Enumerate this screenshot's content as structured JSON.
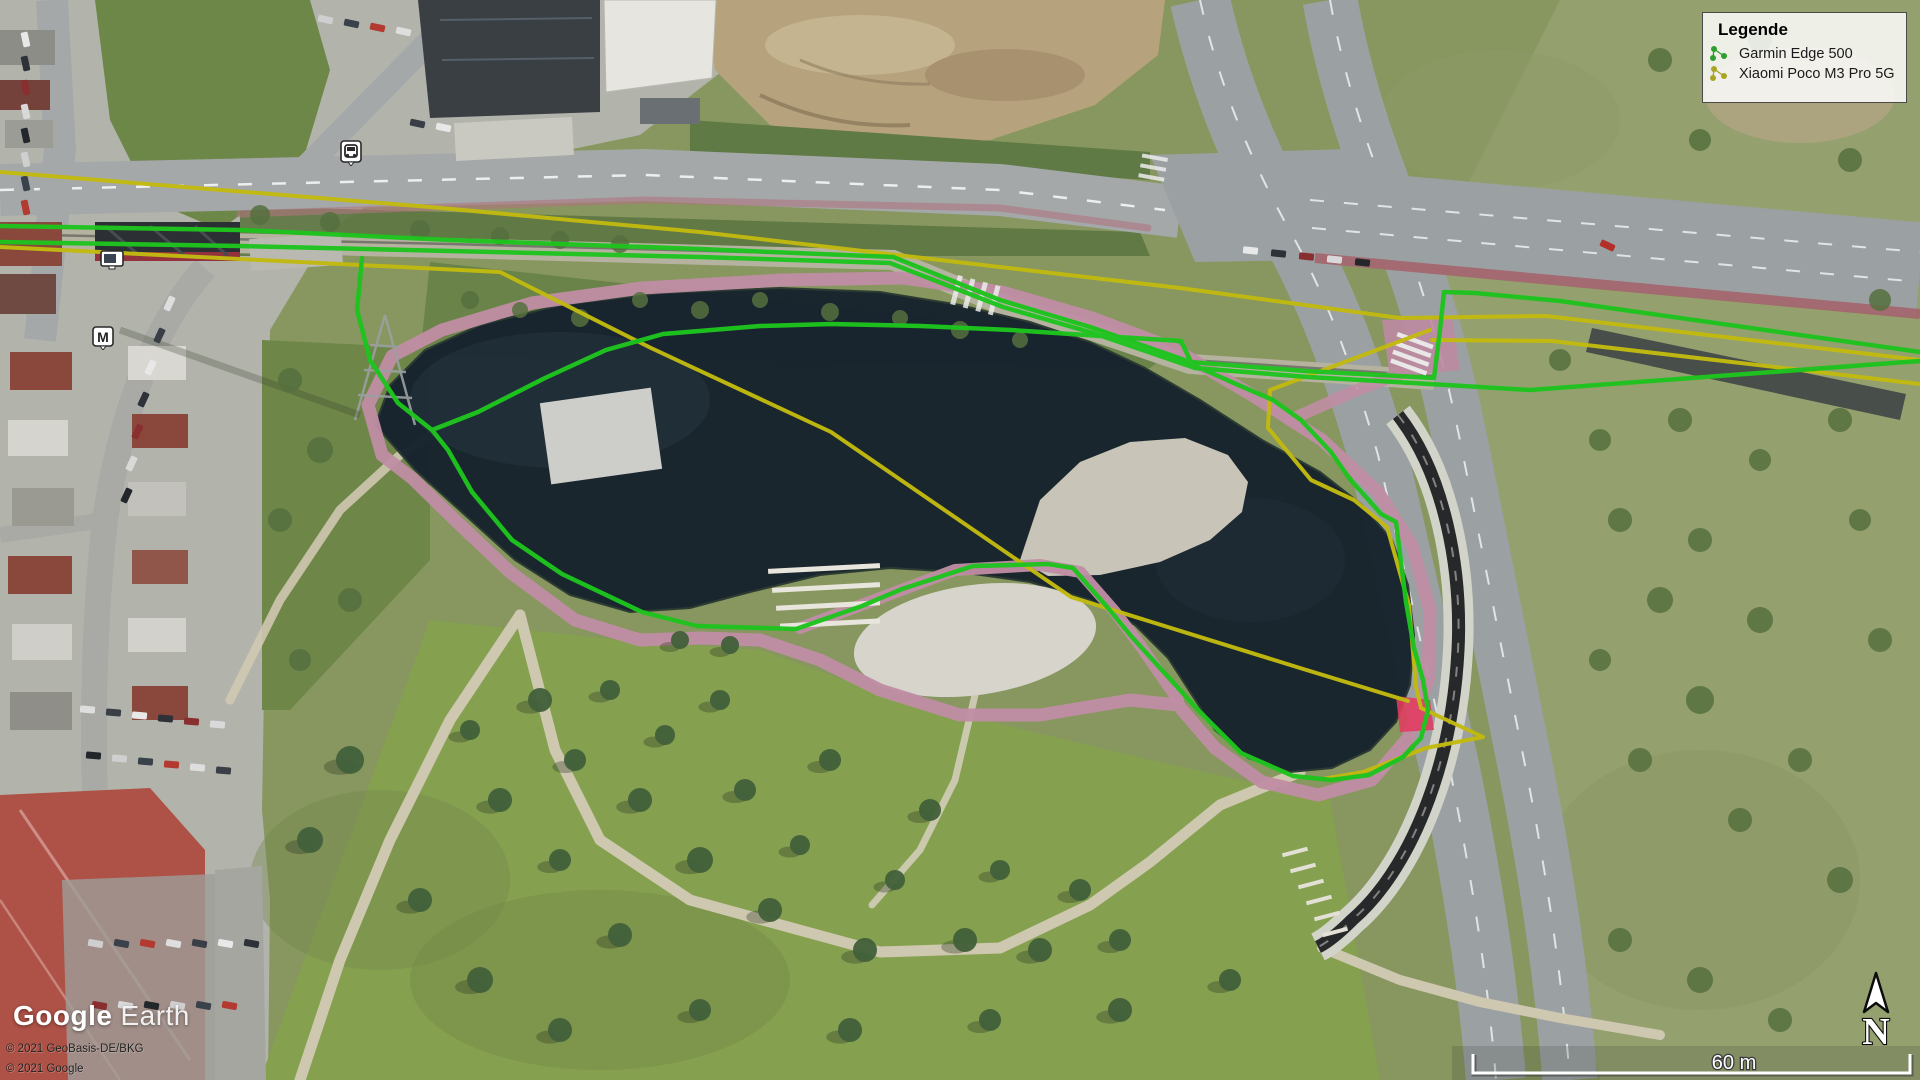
{
  "app": {
    "title": "Google Earth"
  },
  "legend": {
    "title": "Legende",
    "items": [
      {
        "id": "garmin",
        "label": "Garmin Edge 500",
        "color": "#2f9e2f"
      },
      {
        "id": "xiaomi",
        "label": "Xiaomi Poco M3 Pro 5G",
        "color": "#a8a425"
      }
    ]
  },
  "watermark": {
    "brand": "Google",
    "product": "Earth"
  },
  "attribution": {
    "line1": "© 2021 GeoBasis-DE/BKG",
    "line2": "© 2021 Google"
  },
  "scale_bar": {
    "label": "60 m"
  },
  "compass": {
    "label": "N"
  },
  "poi": {
    "station_label": "M"
  },
  "tracks": {
    "series": [
      {
        "id": "xiaomi",
        "color": "#c2ba10",
        "width": 4,
        "segments": [
          [
            [
              0,
              172
            ],
            [
              430,
              207
            ],
            [
              700,
              232
            ],
            [
              1180,
              288
            ],
            [
              1400,
              318
            ],
            [
              1546,
              316
            ],
            [
              1920,
              360
            ]
          ],
          [
            [
              0,
              247
            ],
            [
              300,
              262
            ],
            [
              500,
              272
            ],
            [
              651,
              348
            ],
            [
              831,
              432
            ],
            [
              1071,
              597
            ],
            [
              1300,
              668
            ],
            [
              1408,
              701
            ]
          ],
          [
            [
              1430,
              330
            ],
            [
              1302,
              378
            ],
            [
              1270,
              390
            ],
            [
              1268,
              428
            ],
            [
              1311,
              480
            ],
            [
              1354,
              500
            ],
            [
              1387,
              527
            ],
            [
              1409,
              605
            ],
            [
              1416,
              687
            ],
            [
              1421,
              708
            ],
            [
              1483,
              737
            ],
            [
              1426,
              748
            ],
            [
              1363,
              772
            ],
            [
              1323,
              779
            ]
          ],
          [
            [
              1432,
              340
            ],
            [
              1552,
              341
            ],
            [
              1920,
              384
            ]
          ]
        ]
      },
      {
        "id": "garmin",
        "color": "#1ec41e",
        "width": 4.5,
        "segments": [
          [
            [
              0,
              226
            ],
            [
              240,
              230
            ],
            [
              450,
              240
            ],
            [
              700,
              249
            ],
            [
              893,
              257
            ],
            [
              1000,
              300
            ],
            [
              1090,
              327
            ],
            [
              1190,
              362
            ],
            [
              1305,
              371
            ],
            [
              1434,
              378
            ],
            [
              1440,
              330
            ],
            [
              1444,
              292
            ],
            [
              1475,
              293
            ],
            [
              1560,
              301
            ],
            [
              1920,
              352
            ]
          ],
          [
            [
              0,
              242
            ],
            [
              240,
              246
            ],
            [
              450,
              251
            ],
            [
              700,
              257
            ],
            [
              890,
              263
            ],
            [
              1003,
              307
            ],
            [
              1093,
              333
            ],
            [
              1195,
              368
            ],
            [
              1308,
              377
            ],
            [
              1430,
              384
            ],
            [
              1530,
              390
            ],
            [
              1920,
              361
            ]
          ],
          [
            [
              362,
              258
            ],
            [
              357,
              310
            ],
            [
              370,
              360
            ],
            [
              398,
              403
            ],
            [
              432,
              430
            ],
            [
              448,
              450
            ],
            [
              472,
              492
            ],
            [
              512,
              540
            ],
            [
              562,
              574
            ],
            [
              642,
              612
            ],
            [
              697,
              626
            ],
            [
              796,
              629
            ],
            [
              862,
              606
            ],
            [
              902,
              589
            ],
            [
              973,
              566
            ],
            [
              1048,
              564
            ],
            [
              1073,
              568
            ],
            [
              1108,
              608
            ],
            [
              1131,
              636
            ],
            [
              1200,
              712
            ],
            [
              1241,
              753
            ],
            [
              1293,
              776
            ],
            [
              1331,
              780
            ],
            [
              1369,
              775
            ],
            [
              1403,
              757
            ],
            [
              1421,
              738
            ],
            [
              1428,
              710
            ],
            [
              1423,
              680
            ],
            [
              1414,
              648
            ],
            [
              1406,
              602
            ],
            [
              1396,
              522
            ],
            [
              1381,
              514
            ],
            [
              1349,
              478
            ],
            [
              1331,
              452
            ],
            [
              1301,
              420
            ],
            [
              1273,
              400
            ],
            [
              1236,
              384
            ],
            [
              1191,
              364
            ]
          ],
          [
            [
              432,
              430
            ],
            [
              478,
              412
            ],
            [
              545,
              378
            ],
            [
              606,
              350
            ],
            [
              663,
              334
            ],
            [
              760,
              326
            ],
            [
              831,
              324
            ],
            [
              921,
              326
            ],
            [
              1011,
              330
            ],
            [
              1101,
              336
            ],
            [
              1181,
              341
            ],
            [
              1191,
              362
            ]
          ]
        ]
      }
    ],
    "event_marker": {
      "color": "#e23b5f",
      "points": [
        [
          1396,
          696
        ],
        [
          1430,
          700
        ],
        [
          1434,
          730
        ],
        [
          1400,
          732
        ]
      ]
    }
  }
}
